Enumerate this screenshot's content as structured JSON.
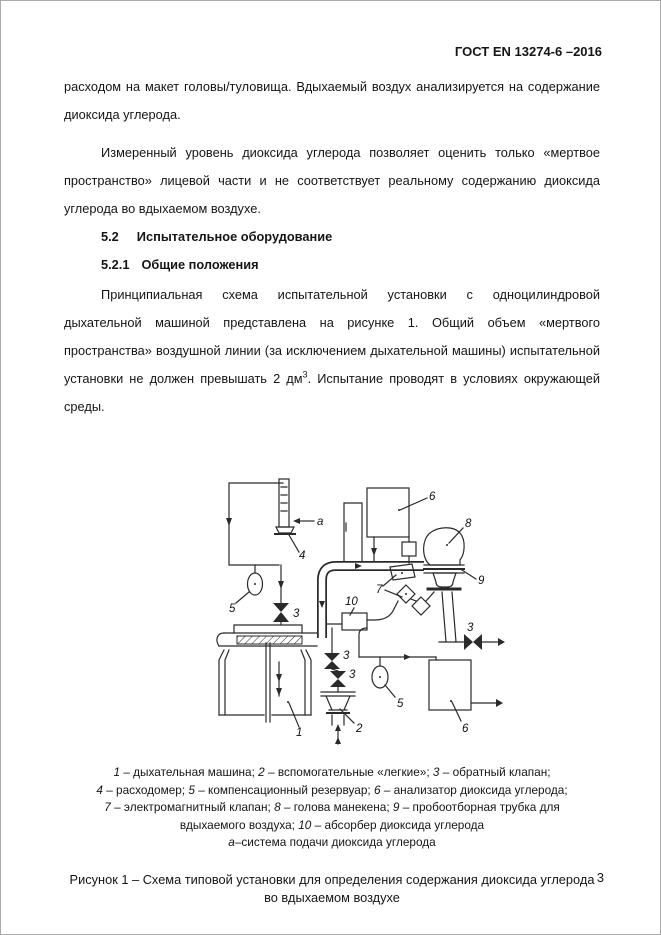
{
  "page": {
    "header": "ГОСТ EN 13274-6 –2016",
    "page_number": "3"
  },
  "body": {
    "p1": "расходом на макет головы/туловища. Вдыхаемый воздух анализируется на содержание диоксида углерода.",
    "p2": "Измеренный уровень диоксида углерода позволяет оценить только «мертвое пространство» лицевой части и не соответствует реальному содержанию диоксида углерода во вдыхаемом воздухе.",
    "h_52_num": "5.2",
    "h_52_title": "Испытательное оборудование",
    "h_521_num": "5.2.1",
    "h_521_title": "Общие положения",
    "p3_before_sup": "Принципиальная схема испытательной установки с одноцилиндровой дыхательной машиной представлена на рисунке 1. Общий объем «мертвого пространства» воздушной линии (за исключением дыхательной машины) испытательной установки не должен превышать 2 дм",
    "p3_sup": "3",
    "p3_after_sup": ". Испытание проводят в условиях окружающей среды."
  },
  "figure": {
    "labels": {
      "machine": "1",
      "lungs": "2",
      "check_valve": "3",
      "flowmeter": "4",
      "reservoir": "5",
      "analyzer": "6",
      "solenoid_valve": "7",
      "head": "8",
      "probe": "9",
      "absorber": "10",
      "co2_supply": "a"
    },
    "legend_lines": [
      [
        {
          "em": "1"
        },
        {
          "t": " – дыхательная машина; "
        },
        {
          "em": "2"
        },
        {
          "t": " – вспомогательные «легкие»; "
        },
        {
          "em": "3"
        },
        {
          "t": " – обратный клапан;"
        }
      ],
      [
        {
          "em": "4"
        },
        {
          "t": " – расходомер; "
        },
        {
          "em": "5"
        },
        {
          "t": " – компенсационный резервуар; "
        },
        {
          "em": "6"
        },
        {
          "t": " – анализатор диоксида углерода;"
        }
      ],
      [
        {
          "em": "7"
        },
        {
          "t": " – электромагнитный клапан; "
        },
        {
          "em": "8"
        },
        {
          "t": " – голова манекена; "
        },
        {
          "em": "9"
        },
        {
          "t": " – пробоотборная трубка для"
        }
      ],
      [
        {
          "t": "вдыхаемого воздуха; "
        },
        {
          "em": "10"
        },
        {
          "t": " – абсорбер диоксида углерода"
        }
      ],
      [
        {
          "em": "а"
        },
        {
          "t": "–система подачи диоксида углерода"
        }
      ]
    ],
    "caption_line1": "Рисунок 1 – Схема типовой установки для определения содержания диоксида углерода",
    "caption_line2": "во вдыхаемом воздухе"
  }
}
